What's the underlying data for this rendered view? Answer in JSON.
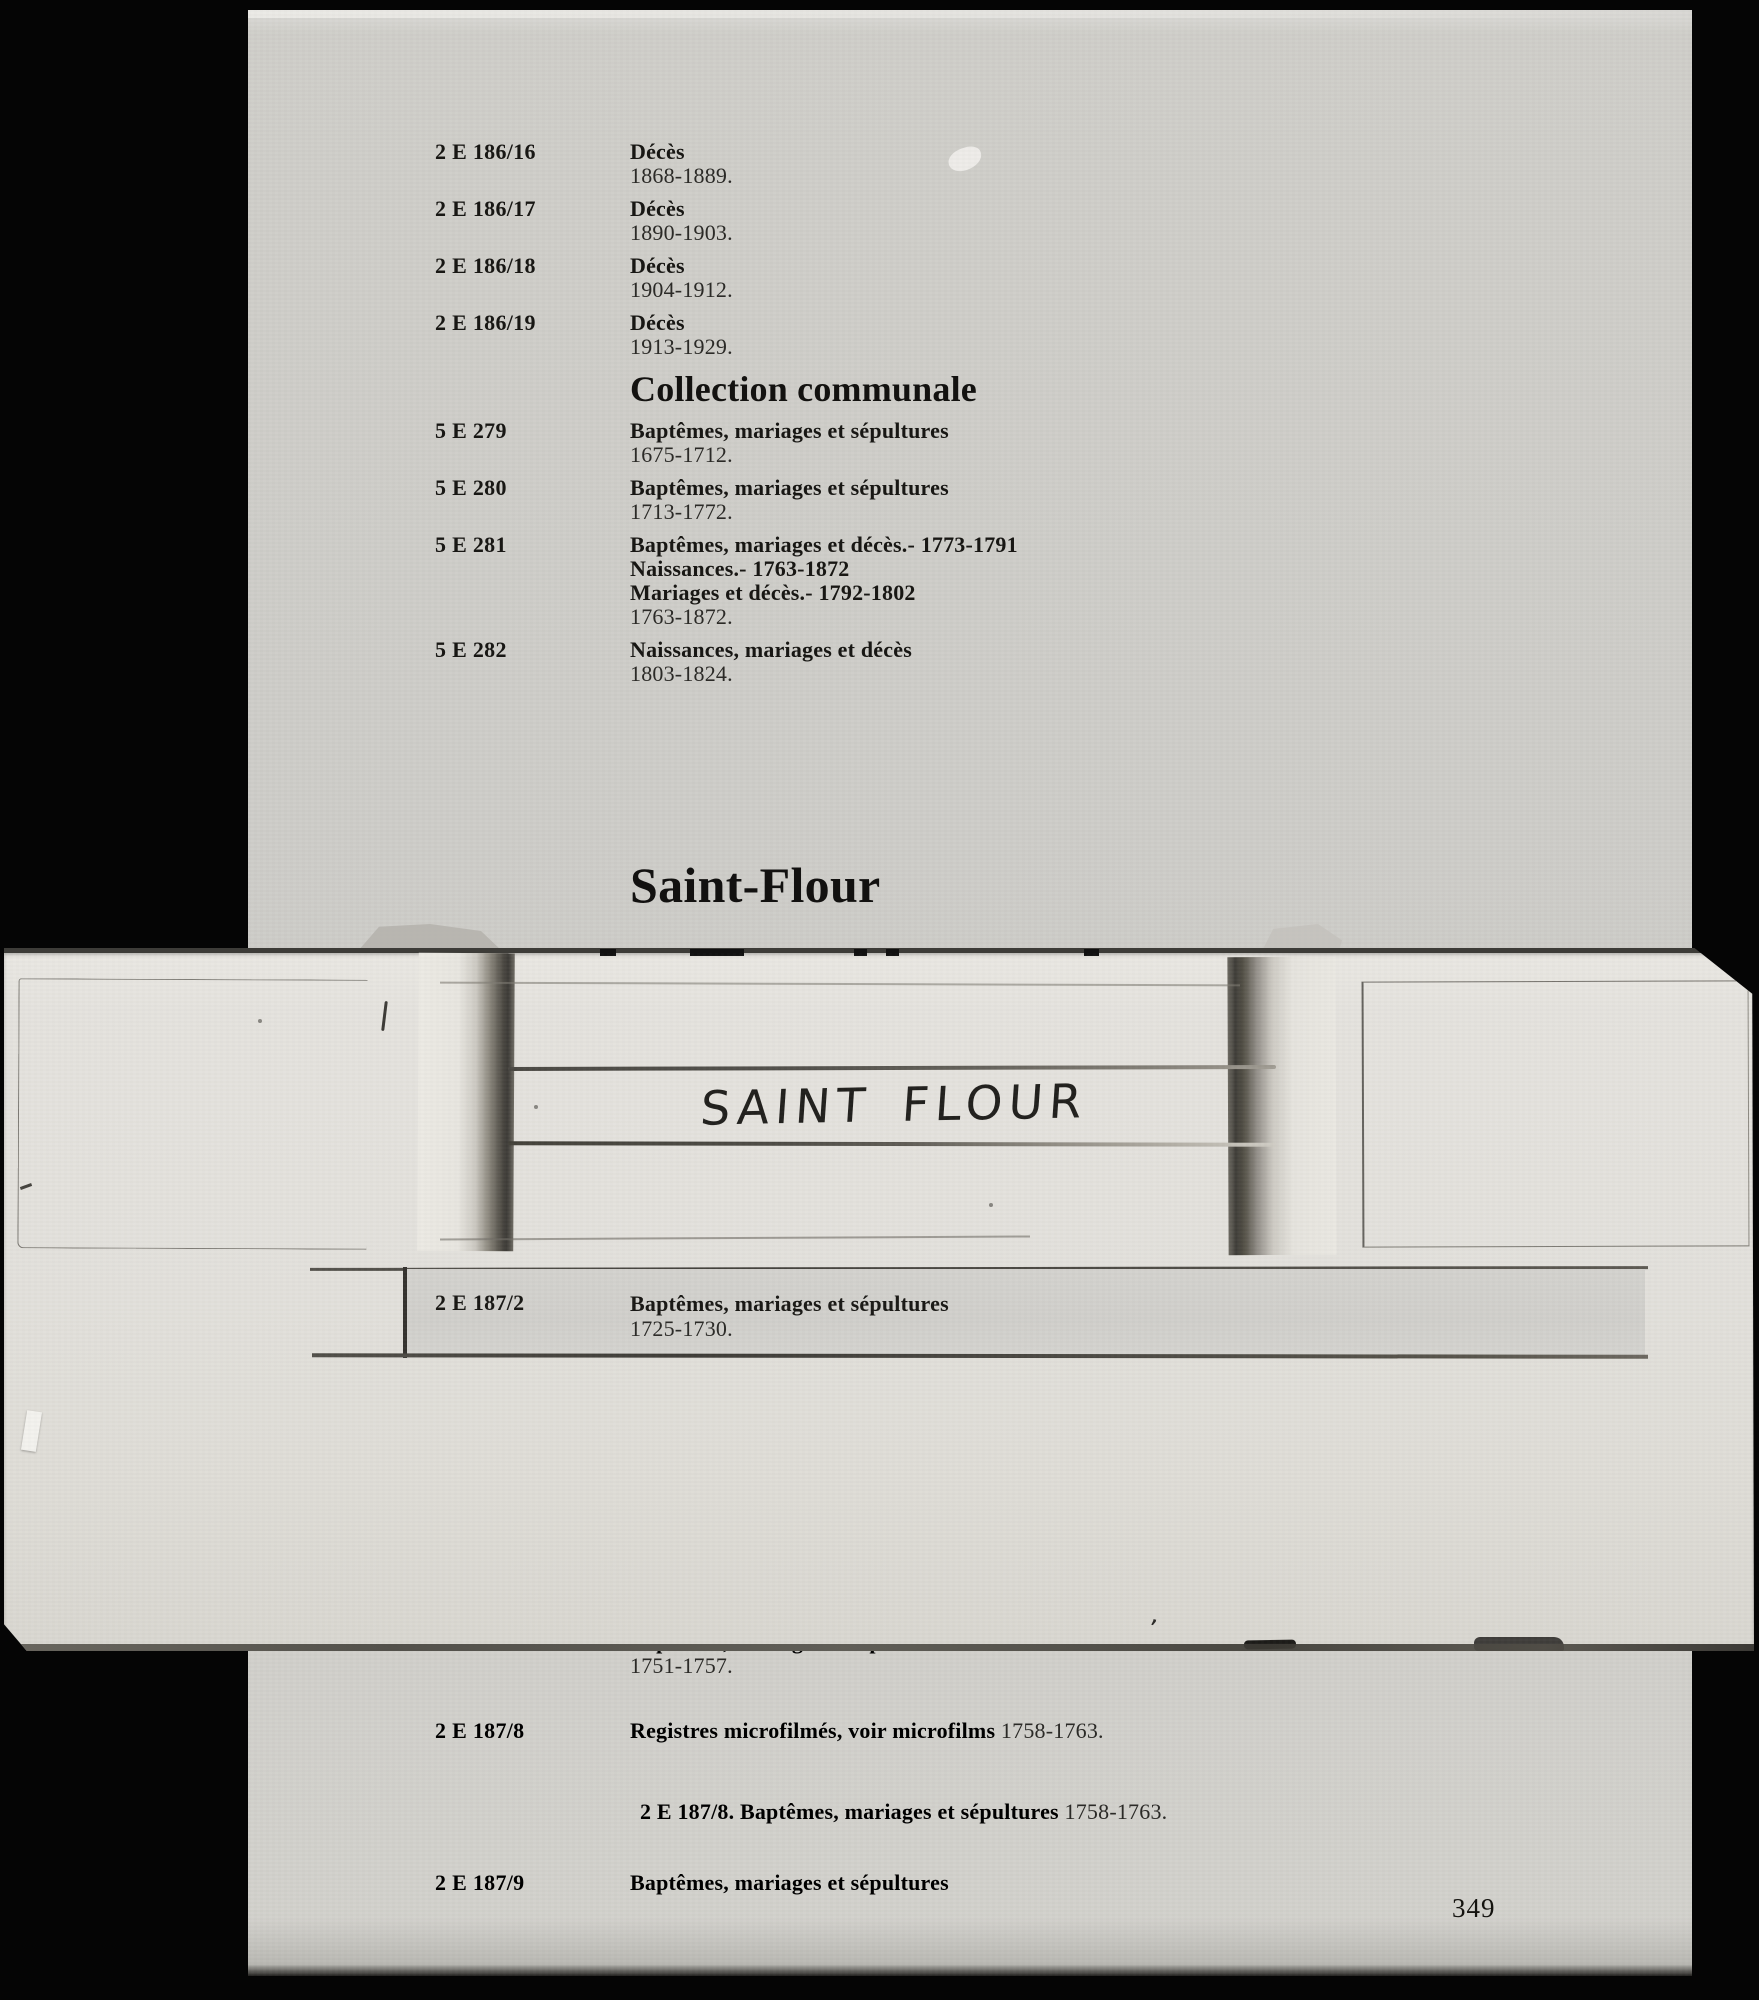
{
  "document": {
    "page_number": "349",
    "section_heading": "Collection communale",
    "place_heading": "Saint-Flour"
  },
  "top_entries": [
    {
      "ref": "2 E 186/16",
      "lines": [
        {
          "b": "Décès",
          "r": ""
        },
        {
          "b": "",
          "r": "1868-1889."
        }
      ]
    },
    {
      "ref": "2 E 186/17",
      "lines": [
        {
          "b": "Décès",
          "r": ""
        },
        {
          "b": "",
          "r": "1890-1903."
        }
      ]
    },
    {
      "ref": "2 E 186/18",
      "lines": [
        {
          "b": "Décès",
          "r": ""
        },
        {
          "b": "",
          "r": "1904-1912."
        }
      ]
    },
    {
      "ref": "2 E 186/19",
      "lines": [
        {
          "b": "Décès",
          "r": ""
        },
        {
          "b": "",
          "r": "1913-1929."
        }
      ]
    }
  ],
  "communal_entries": [
    {
      "ref": "5 E 279",
      "lines": [
        {
          "b": "Baptêmes, mariages et sépultures",
          "r": ""
        },
        {
          "b": "",
          "r": "1675-1712."
        }
      ]
    },
    {
      "ref": "5 E 280",
      "lines": [
        {
          "b": "Baptêmes, mariages et sépultures",
          "r": ""
        },
        {
          "b": "",
          "r": "1713-1772."
        }
      ]
    },
    {
      "ref": "5 E 281",
      "lines": [
        {
          "b": "Baptêmes, mariages et décès.- 1773-1791",
          "r": ""
        },
        {
          "b": "Naissances.- 1763-1872",
          "r": ""
        },
        {
          "b": "Mariages et décès.- 1792-1802",
          "r": ""
        },
        {
          "b": "",
          "r": "1763-1872."
        }
      ]
    },
    {
      "ref": "5 E 282",
      "lines": [
        {
          "b": "Naissances, mariages et décès",
          "r": ""
        },
        {
          "b": "",
          "r": "1803-1824."
        }
      ]
    }
  ],
  "slip": {
    "handwritten_label": "SAINT FLOUR",
    "window_entries": [
      {
        "ref": "2 E 187/2",
        "lines": [
          {
            "b": "Baptêmes, mariages et sépultures",
            "r": ""
          },
          {
            "b": "",
            "r": "1725-1730."
          }
        ]
      }
    ]
  },
  "bottom_entries": [
    {
      "ref": "2 E 187/7",
      "lines": [
        {
          "b": "Baptêmes, mariages et sépultures",
          "r": ""
        },
        {
          "b": "",
          "r": "1751-1757."
        }
      ]
    },
    {
      "ref": "2 E 187/8",
      "lines": [
        {
          "b": "Registres microfilmés, voir microfilms",
          "r": " 1758-1763."
        }
      ]
    },
    {
      "ref": "",
      "indent": true,
      "lines": [
        {
          "b": "2 E 187/8. Baptêmes, mariages et sépultures",
          "r": " 1758-1763."
        }
      ]
    },
    {
      "ref": "2 E 187/9",
      "lines": [
        {
          "b": "Baptêmes, mariages et sépultures",
          "r": ""
        }
      ]
    }
  ]
}
